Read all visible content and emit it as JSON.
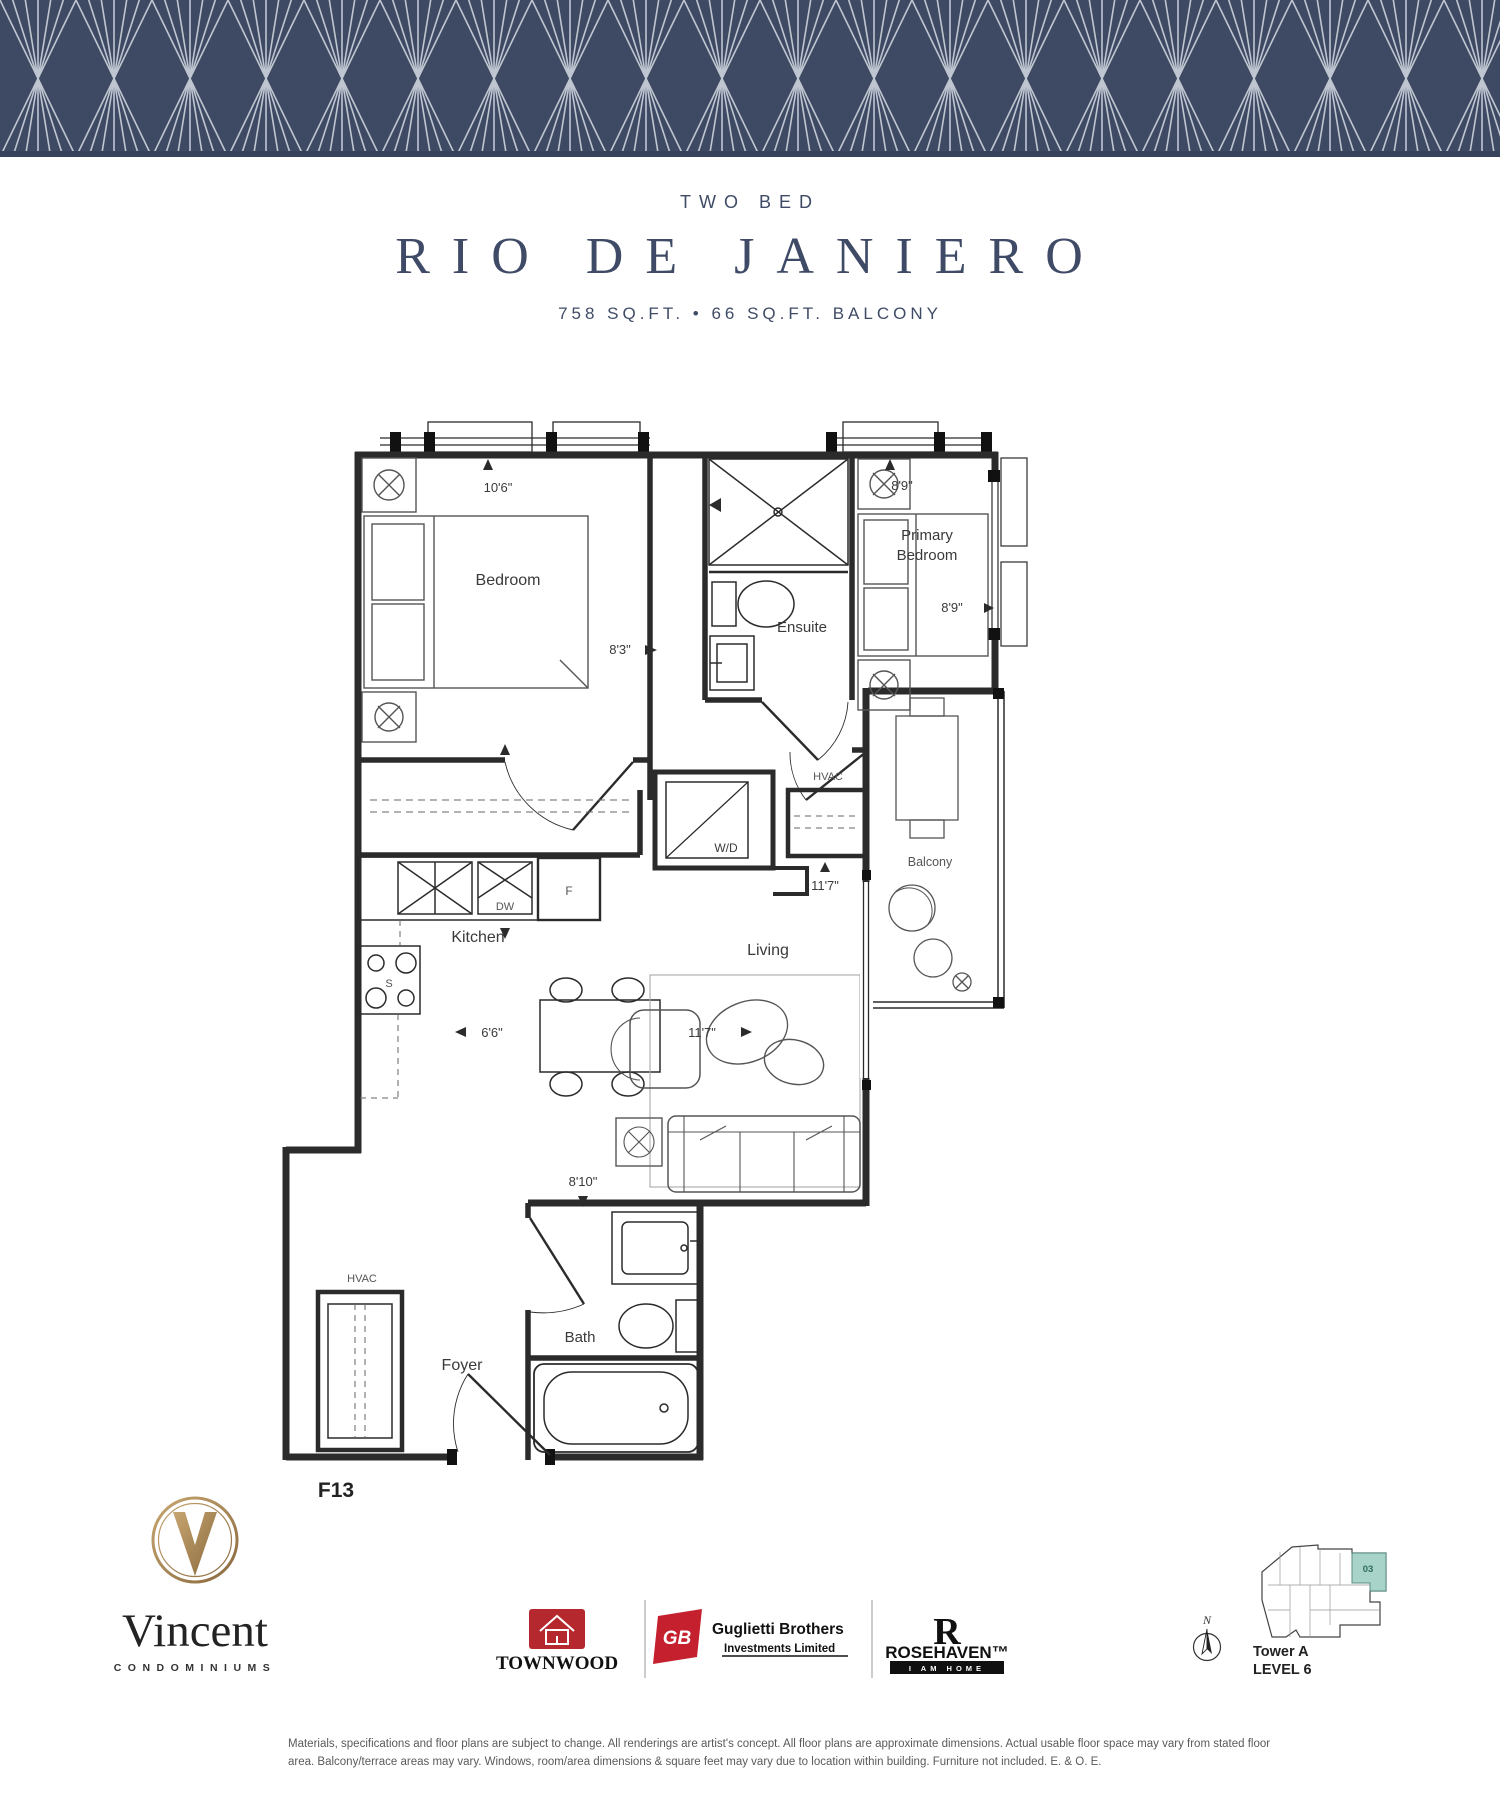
{
  "header": {
    "category": "TWO BED",
    "title": "RIO DE JANIERO",
    "area": "758 SQ.FT. • 66 SQ.FT. BALCONY"
  },
  "plan": {
    "unit_label": "F13",
    "rooms": {
      "bedroom": "Bedroom",
      "ensuite": "Ensuite",
      "primary_line1": "Primary",
      "primary_line2": "Bedroom",
      "kitchen": "Kitchen",
      "living": "Living",
      "balcony": "Balcony",
      "foyer": "Foyer",
      "bath": "Bath",
      "hvac_upper": "HVAC",
      "hvac_lower": "HVAC",
      "washer_dryer": "W/D",
      "fridge": "F",
      "dishwasher": "DW",
      "stove": "S"
    },
    "dims": {
      "bedroom_w": "10'6\"",
      "bedroom_d": "8'3\"",
      "primary_w": "8'9\"",
      "primary_d": "8'9\"",
      "closet": "11'7\"",
      "kitchen": "6'6\"",
      "living": "11'7\"",
      "foyer": "8'10\""
    }
  },
  "footer": {
    "brand": {
      "name": "Vincent",
      "type": "CONDOMINIUMS"
    },
    "builders": {
      "townwood": "TOWNWOOD",
      "guglietti_line1": "Guglietti Brothers",
      "guglietti_line2": "Investments Limited",
      "guglietti_mark": "GB",
      "rosehaven": "ROSEHAVEN™",
      "rosehaven_tag": "I AM HOME"
    },
    "compass": "N",
    "keyplan": {
      "tower": "Tower A",
      "level": "LEVEL 6",
      "unit": "03"
    },
    "disclaimer": "Materials, specifications and floor plans are subject to change. All renderings are artist's concept. All floor plans are approximate dimensions. Actual usable floor space may vary from stated floor area. Balcony/terrace areas may vary. Windows, room/area dimensions & square feet may vary due to location within building. Furniture not included. E. & O. E."
  },
  "colors": {
    "banner_navy": "#3e4a63",
    "banner_line": "#cad0da",
    "title_navy": "#3f4b66",
    "wall": "#2b2b2b",
    "furniture": "#555555",
    "keyplan_highlight": "#a8d3c8",
    "logo_gold": "#ab8b5a",
    "townwood_red": "#b5282e",
    "guglietti_red": "#c4202e"
  }
}
